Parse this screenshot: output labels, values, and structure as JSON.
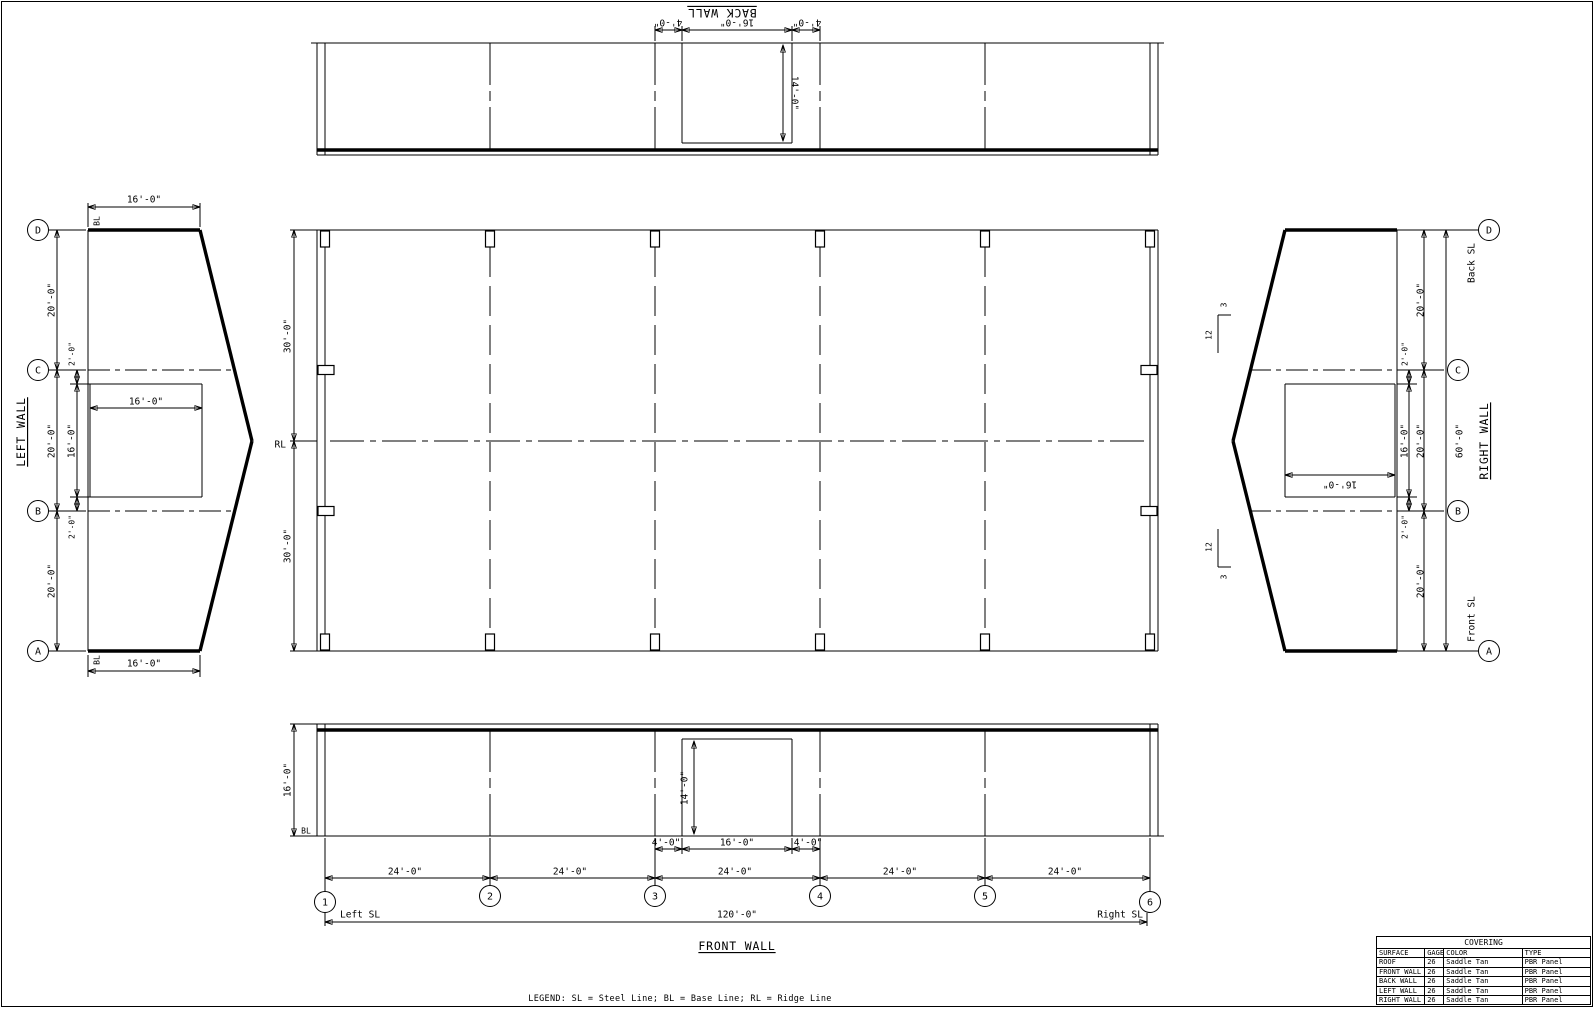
{
  "legend": {
    "text": "LEGEND:  SL = Steel Line;  BL = Base Line;  RL = Ridge Line"
  },
  "grids": {
    "rows": [
      "D",
      "C",
      "B",
      "A"
    ],
    "cols": [
      "1",
      "2",
      "3",
      "4",
      "5",
      "6"
    ]
  },
  "back_wall": {
    "title": "BACK WALL",
    "jamb_left": "4'-0\"",
    "opening_width": "16'-0\"",
    "jamb_right": "4'-0\"",
    "opening_height": "14'-0\""
  },
  "left_wall": {
    "title": "LEFT WALL",
    "eave_top": "16'-0\"",
    "eave_bottom": "16'-0\"",
    "bl_top": "BL",
    "bl_bottom": "BL",
    "bay_d_c": "20'-0\"",
    "bay_c_b": "20'-0\"",
    "bay_b_a": "20'-0\"",
    "edge_top": "2'-0\"",
    "edge_bottom": "2'-0\"",
    "opening_height": "16'-0\"",
    "opening_width": "16'-0\""
  },
  "plan": {
    "half_back": "30'-0\"",
    "half_front": "30'-0\"",
    "ridge": "RL"
  },
  "right_wall": {
    "title": "RIGHT WALL",
    "back_sl": "Back SL",
    "front_sl": "Front SL",
    "overall": "60'-0\"",
    "bay_d_c": "20'-0\"",
    "bay_c_b": "20'-0\"",
    "bay_b_a": "20'-0\"",
    "edge_top": "2'-0\"",
    "edge_bottom": "2'-0\"",
    "opening_height": "16'-0\"",
    "opening_width": "16'-0\"",
    "pitch_run": "12",
    "pitch_rise": "3"
  },
  "front_wall": {
    "title": "FRONT WALL",
    "eave_height": "16'-0\"",
    "bl": "BL",
    "opening_height": "14'-0\"",
    "jamb_left": "4'-0\"",
    "opening_width": "16'-0\"",
    "jamb_right": "4'-0\"",
    "bays": [
      "24'-0\"",
      "24'-0\"",
      "24'-0\"",
      "24'-0\"",
      "24'-0\""
    ],
    "left_sl": "Left SL",
    "right_sl": "Right SL",
    "overall": "120'-0\""
  },
  "covering": {
    "title": "COVERING",
    "headers": [
      "SURFACE",
      "GAGE",
      "COLOR",
      "TYPE"
    ],
    "rows": [
      [
        "ROOF",
        "26",
        "Saddle Tan",
        "PBR Panel"
      ],
      [
        "FRONT WALL",
        "26",
        "Saddle Tan",
        "PBR Panel"
      ],
      [
        "BACK WALL",
        "26",
        "Saddle Tan",
        "PBR Panel"
      ],
      [
        "LEFT WALL",
        "26",
        "Saddle Tan",
        "PBR Panel"
      ],
      [
        "RIGHT WALL",
        "26",
        "Saddle Tan",
        "PBR Panel"
      ]
    ]
  }
}
